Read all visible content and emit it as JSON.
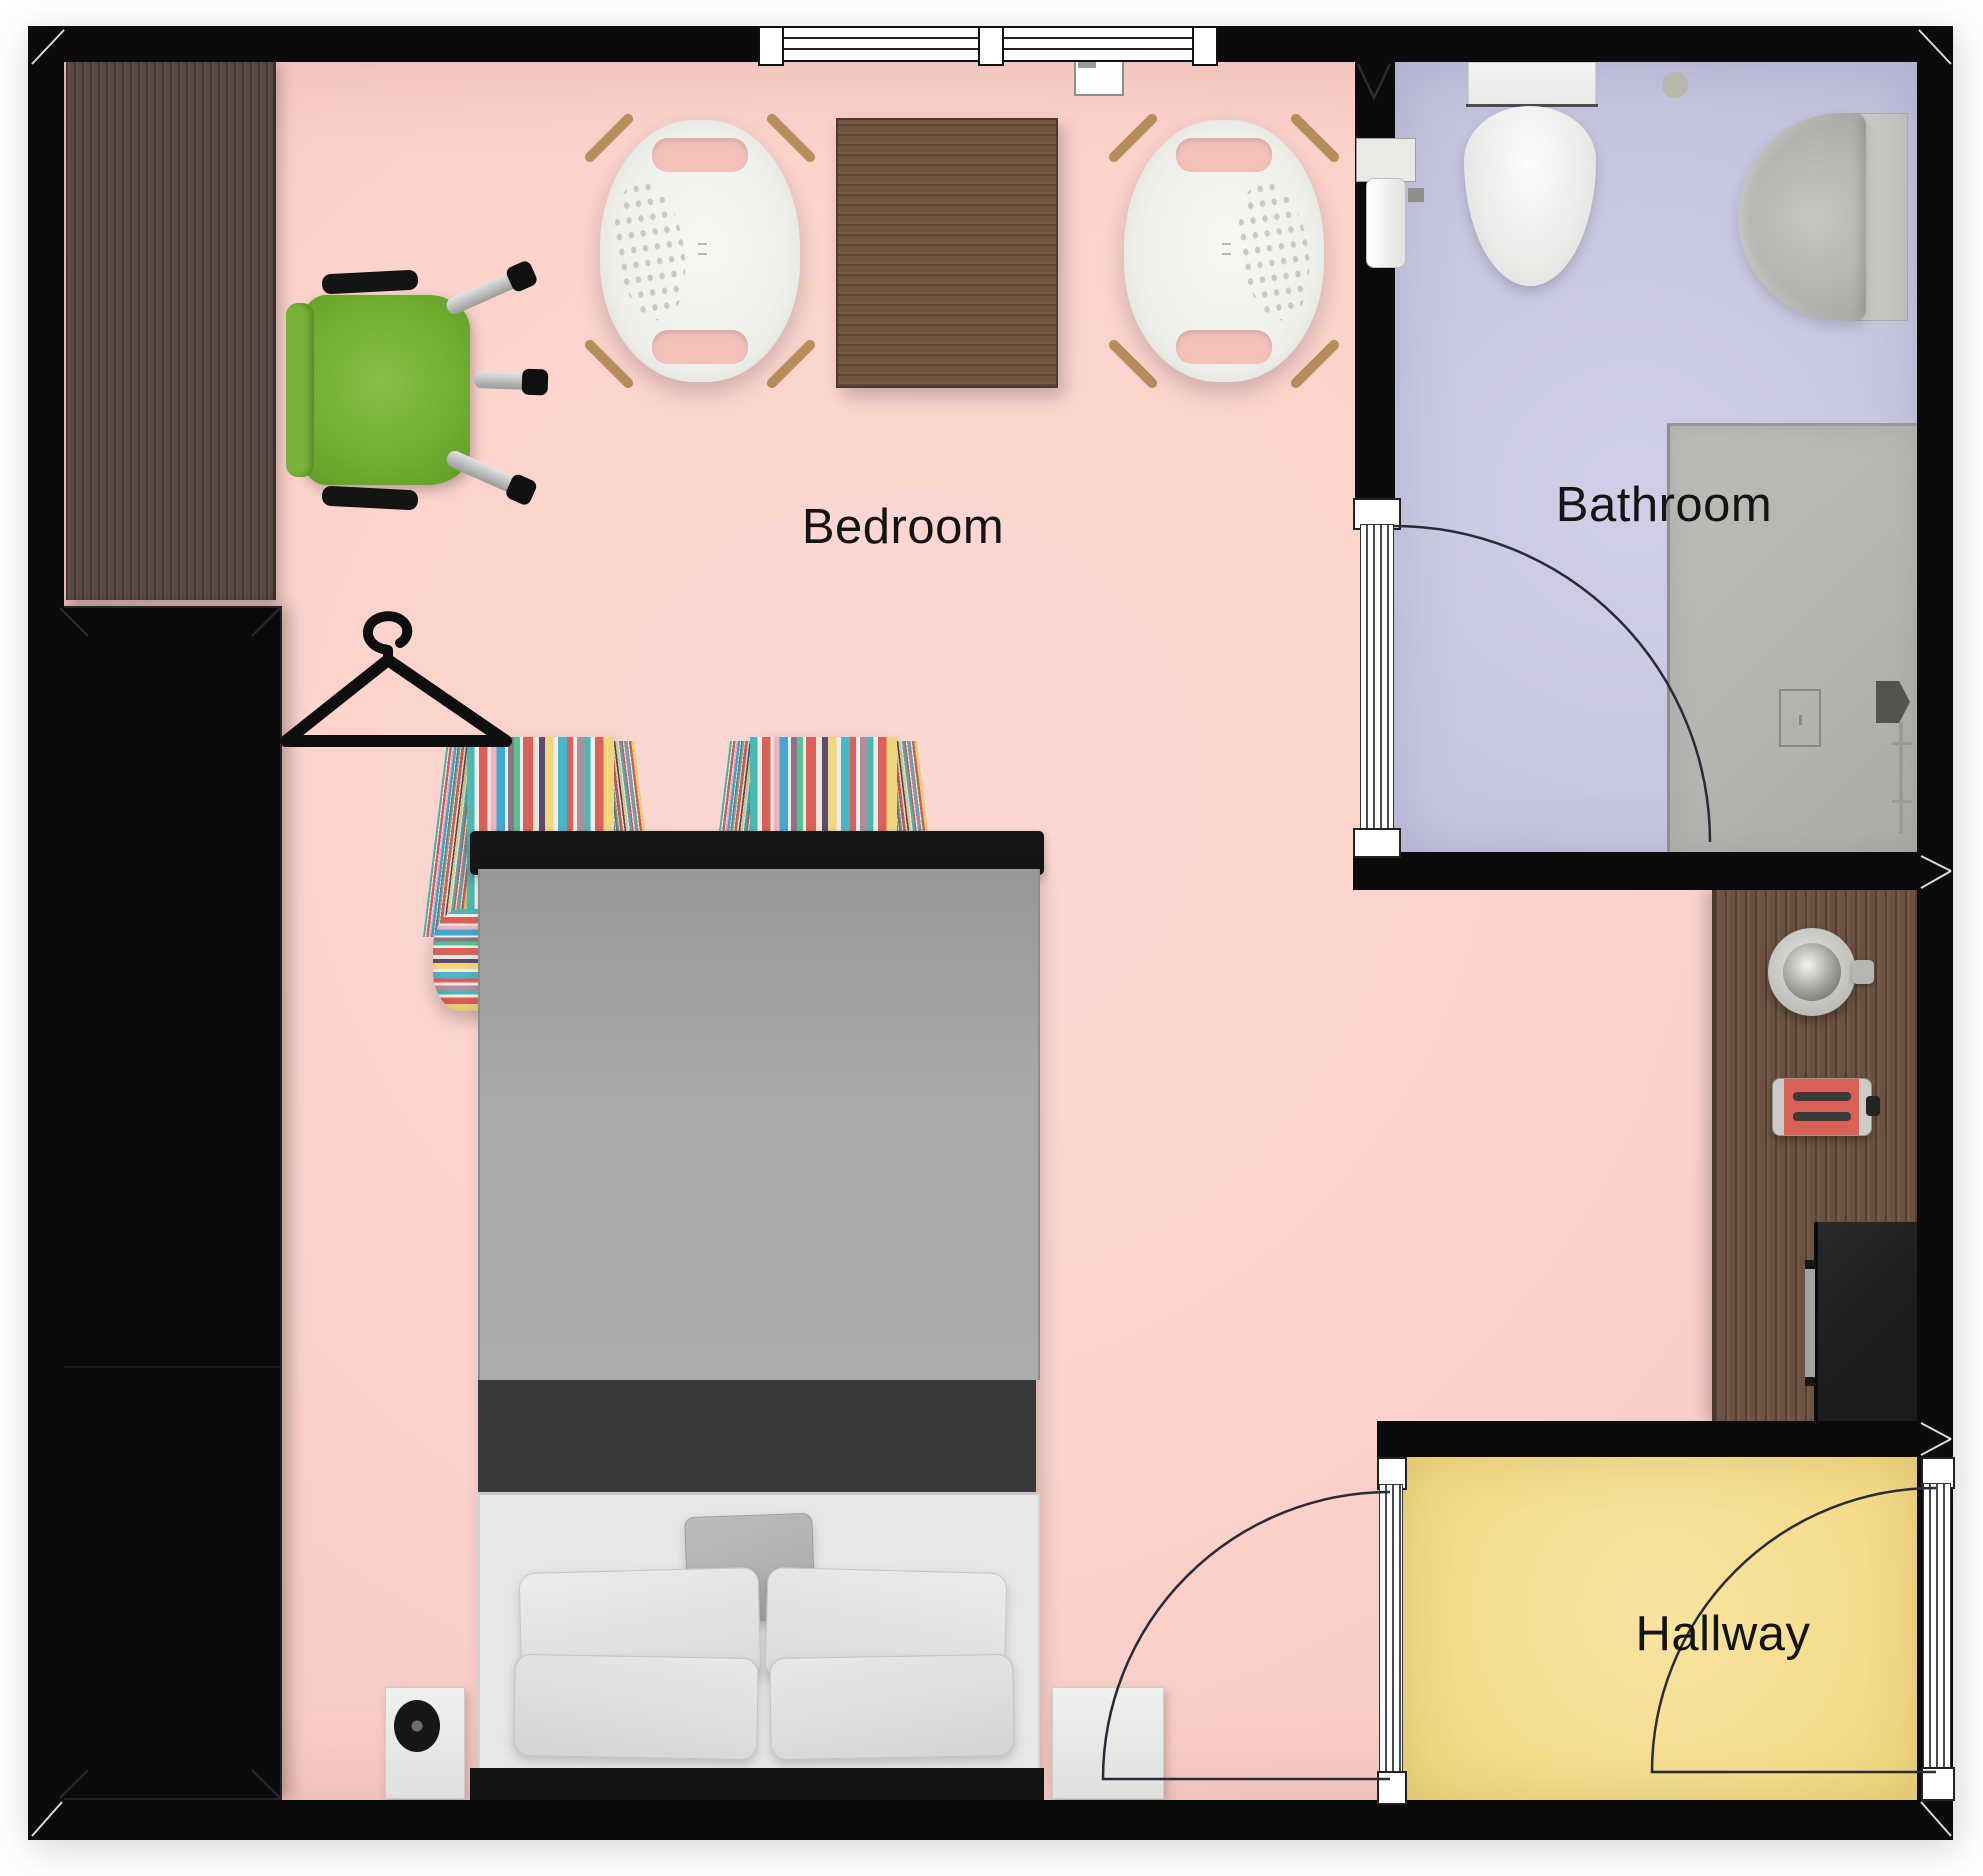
{
  "plan": {
    "type": "floor-plan",
    "canvas": {
      "width_px": 1983,
      "height_px": 1876
    },
    "rooms": [
      {
        "name": "bedroom",
        "label": "Bedroom",
        "floor_color": "#fbd1cb"
      },
      {
        "name": "bathroom",
        "label": "Bathroom",
        "floor_color": "#c8c7e0"
      },
      {
        "name": "hallway",
        "label": "Hallway",
        "floor_color": "#f4dc8c"
      }
    ],
    "colors": {
      "wall": "#0b0b0d",
      "wood_desk": "#5a4740",
      "wood_table": "#6f5440",
      "wood_counter": "#6b5140",
      "office_chair_green": "#6fae2e",
      "toaster_red": "#d96158",
      "bed_blanket_gray": "#a9a9a9",
      "bed_band_dark": "#38383a",
      "sheet_white": "#e7e7e5"
    },
    "architecture": {
      "window": {
        "name": "bedroom-window",
        "wall": "top",
        "panes": 3
      },
      "doors": [
        {
          "name": "bathroom-door",
          "between": [
            "bedroom",
            "bathroom"
          ],
          "swing": "into-bathroom"
        },
        {
          "name": "bedroom-door",
          "between": [
            "bedroom",
            "hallway"
          ],
          "swing": "into-bedroom"
        },
        {
          "name": "entry-door",
          "between": [
            "hallway",
            "outside"
          ],
          "swing": "into-hallway"
        }
      ]
    },
    "furniture": [
      "desk",
      "office-chair",
      "wardrobe",
      "clothes-hanger-icon",
      "lounge-chair-left",
      "side-table",
      "lounge-chair-right",
      "striped-armchair-left",
      "striped-armchair-right",
      "double-bed",
      "nightstand-left",
      "record-disc",
      "nightstand-right",
      "toilet",
      "toilet-paper-holder",
      "wall-switch-box",
      "bathroom-sink",
      "shower",
      "shower-drain",
      "shower-mixer",
      "kitchen-counter",
      "kettle",
      "toaster",
      "mini-fridge"
    ]
  }
}
